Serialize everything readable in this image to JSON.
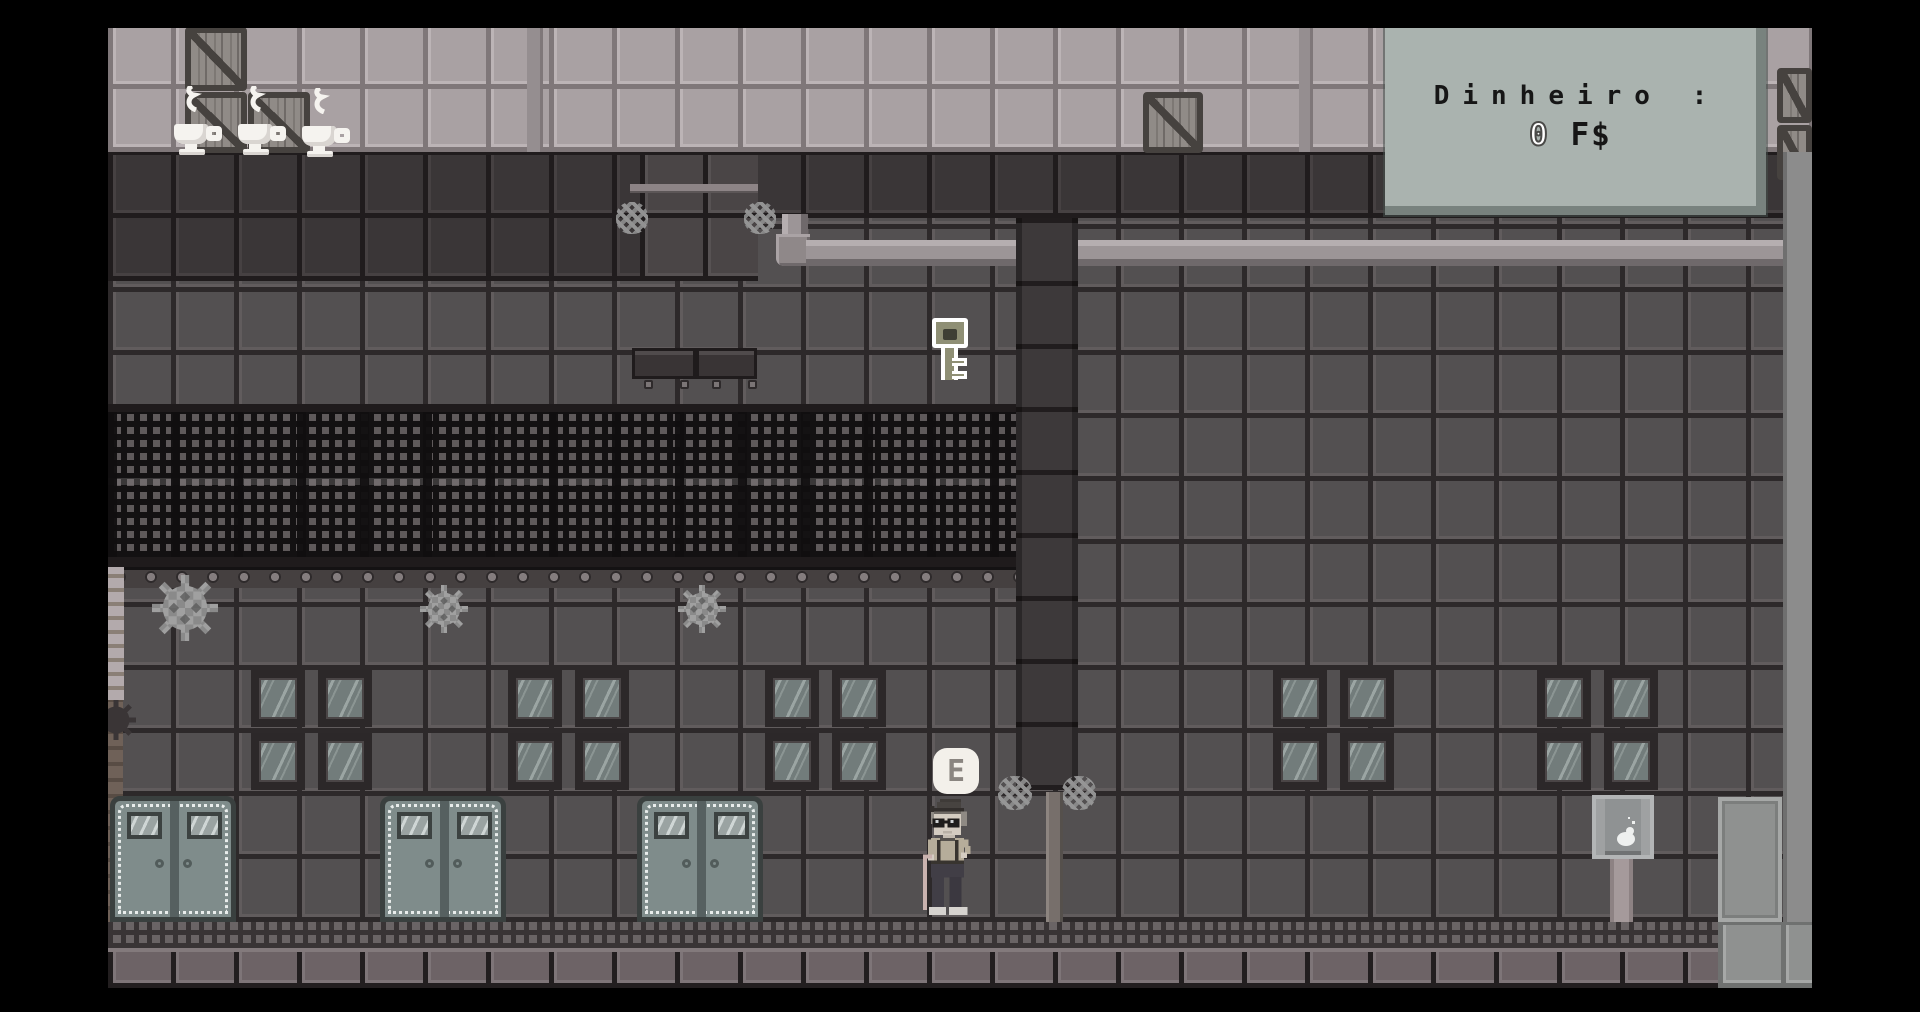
{
  "game": {
    "hud": {
      "money_panel": {
        "label": "Dinheiro :",
        "value": "0",
        "currency": "F$"
      },
      "interact_prompt": {
        "key": "E"
      }
    },
    "scene": {
      "setting": "grayscale pixel-art industrial street with tiled factory wall",
      "entities": {
        "coffee_cups": 3,
        "crates": 6,
        "key": 1,
        "gears": 3,
        "steam_puffs": 4,
        "window_clusters": 5,
        "double_doors": 3,
        "wall_panels": 2,
        "pipe": 1,
        "lamp_post": 1,
        "sign_post": 1,
        "character": "old man with hat, glasses and cane"
      }
    },
    "colors": {
      "letterbox": "#000000",
      "wall_tile": "#535051",
      "wall_tile_dark": "#3a3637",
      "top_band_tile": "#a9a1a3",
      "mesh_band": "#131112",
      "panel_bg": "#aab3af",
      "panel_text": "#161616",
      "pipe": "#9c9597",
      "door": "#7f8c8b",
      "floor": "#6d6366",
      "bubble_bg": "#f3f0ea"
    }
  }
}
